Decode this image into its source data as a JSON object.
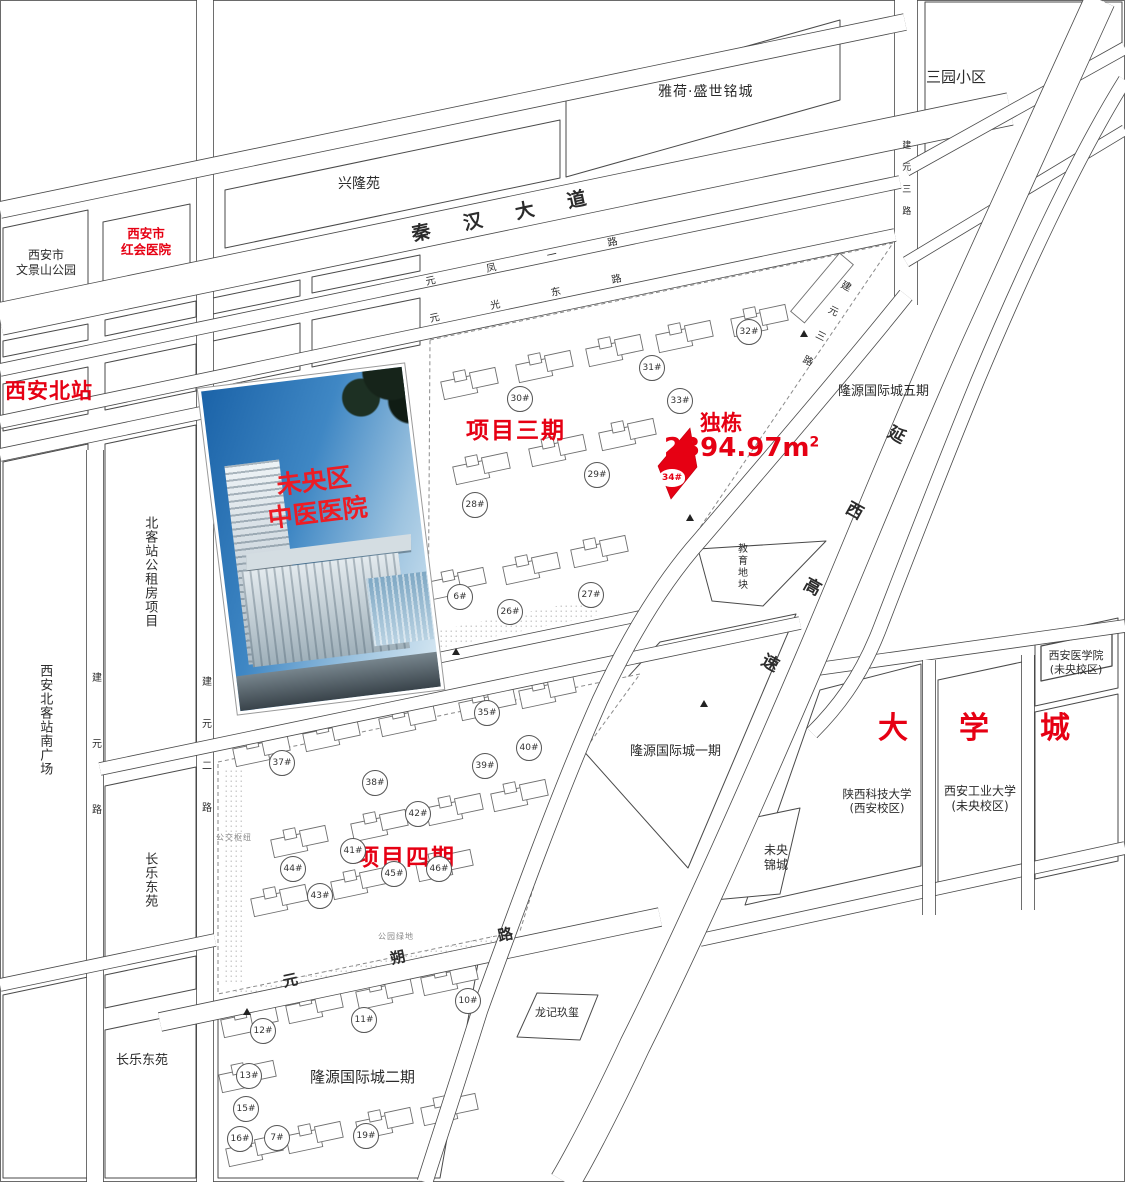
{
  "labels": {
    "sanyuan": "三园小区",
    "yahe": "雅荷·盛世铭城",
    "xinglong": "兴隆苑",
    "wenjing1": "西安市",
    "wenjing2": "文景山公园",
    "honghui1": "西安市",
    "honghui2": "红会医院",
    "beizhan": "西安北站",
    "gongzufang": "北客站公租房项目",
    "nanguangchang": "西安北客站南广场",
    "changle_mid": "长乐东苑",
    "changle_bottom": "长乐东苑",
    "wuqi": "隆源国际城五期",
    "yiqi": "隆源国际城一期",
    "erqi": "隆源国际城二期",
    "jiaoyu": "教育地块",
    "weiyang": "未央 锦城",
    "longji": "龙记玖玺",
    "daxuecheng": "大学城",
    "shankeda1": "陕西科技大学",
    "shankeda2": "(西安校区)",
    "gongye1": "西安工业大学",
    "gongye2": "(未央校区)",
    "yixueyuan1": "西安医学院",
    "yixueyuan2": "(未央校区)",
    "xiangmu3": "项目三期",
    "xiangmu4": "项目四期",
    "dudong": "独栋",
    "area_value": "2394.97m",
    "area_sup": "2",
    "gongjiao": "公交枢纽",
    "gongyuan": "公园绿地"
  },
  "roads": {
    "qinhan": "秦汉大道",
    "yuanfeng": "元凤一路",
    "yuanguang": "元光东路",
    "yuanshuo": "元朔路",
    "jianyuanlu": "建元路",
    "jianyuan2": "建元二路",
    "jianyuan3_top": "建元三路",
    "jianyuan3_diag": "建元三路",
    "yanxi": "延西高速"
  },
  "photo": {
    "line1": "未央区",
    "line2": "中医医院"
  },
  "parcel_badge": "34#",
  "badges3": [
    [
      "26#",
      509,
      611
    ],
    [
      "27#",
      590,
      594
    ],
    [
      "28#",
      474,
      504
    ],
    [
      "29#",
      596,
      474
    ],
    [
      "30#",
      519,
      398
    ],
    [
      "31#",
      651,
      367
    ],
    [
      "32#",
      748,
      331
    ],
    [
      "33#",
      679,
      400
    ],
    [
      "6#",
      459,
      596
    ]
  ],
  "badges4": [
    [
      "35#",
      486,
      712
    ],
    [
      "37#",
      281,
      762
    ],
    [
      "38#",
      374,
      782
    ],
    [
      "39#",
      484,
      765
    ],
    [
      "40#",
      528,
      747
    ],
    [
      "41#",
      352,
      850
    ],
    [
      "42#",
      417,
      813
    ],
    [
      "43#",
      319,
      895
    ],
    [
      "44#",
      292,
      868
    ],
    [
      "45#",
      393,
      873
    ],
    [
      "46#",
      438,
      868
    ]
  ],
  "badges2": [
    [
      "7#",
      276,
      1137
    ],
    [
      "10#",
      467,
      1000
    ],
    [
      "11#",
      363,
      1019
    ],
    [
      "12#",
      262,
      1030
    ],
    [
      "13#",
      248,
      1075
    ],
    [
      "15#",
      245,
      1108
    ],
    [
      "16#",
      239,
      1138
    ],
    [
      "19#",
      365,
      1135
    ]
  ],
  "markers": [
    [
      800,
      330
    ],
    [
      686,
      514
    ],
    [
      700,
      700
    ],
    [
      452,
      648
    ],
    [
      243,
      1008
    ]
  ],
  "colors": {
    "accent_red": "#e60013",
    "line": "#4a4a4a"
  }
}
